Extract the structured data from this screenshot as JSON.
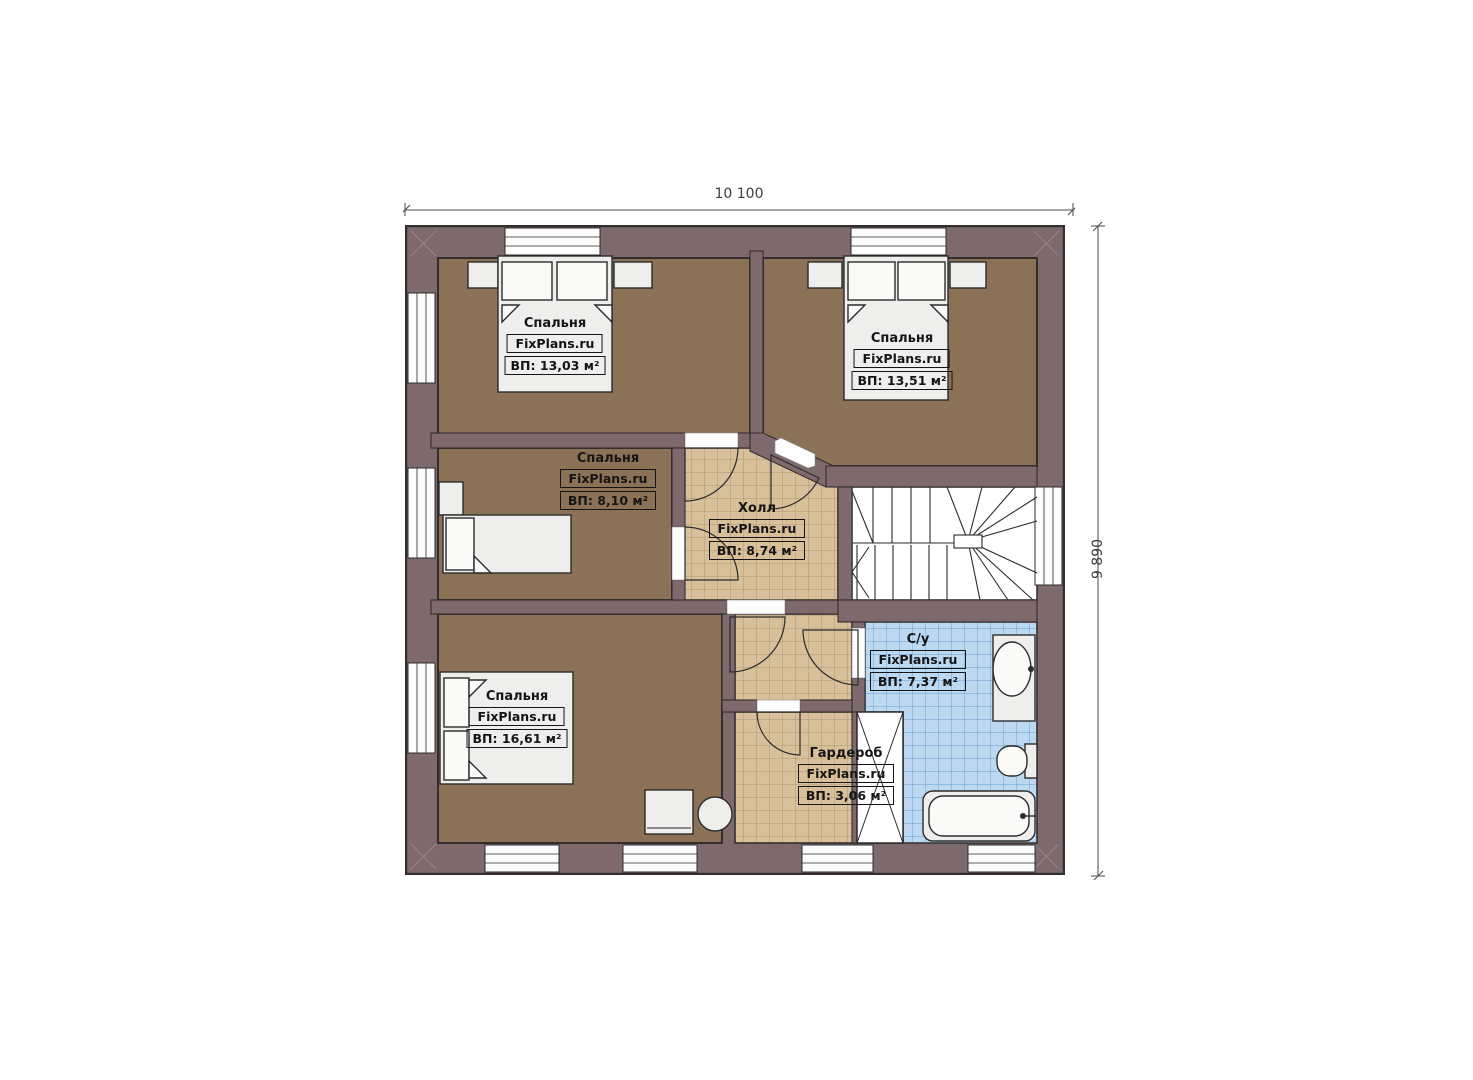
{
  "dimensions": {
    "width_label": "10 100",
    "height_label": "9 890"
  },
  "rooms": [
    {
      "id": "bedroom-top-left",
      "name": "Спальня",
      "watermark": "FixPlans.ru",
      "area": "ВП: 13,03 м²"
    },
    {
      "id": "bedroom-top-right",
      "name": "Спальня",
      "watermark": "FixPlans.ru",
      "area": "ВП: 13,51 м²"
    },
    {
      "id": "bedroom-middle-left",
      "name": "Спальня",
      "watermark": "FixPlans.ru",
      "area": "ВП: 8,10 м²"
    },
    {
      "id": "hall",
      "name": "Холл",
      "watermark": "FixPlans.ru",
      "area": "ВП: 8,74 м²"
    },
    {
      "id": "bedroom-bottom-left",
      "name": "Спальня",
      "watermark": "FixPlans.ru",
      "area": "ВП: 16,61 м²"
    },
    {
      "id": "bathroom",
      "name": "С/у",
      "watermark": "FixPlans.ru",
      "area": "ВП: 7,37 м²"
    },
    {
      "id": "wardrobe",
      "name": "Гардероб",
      "watermark": "FixPlans.ru",
      "area": "ВП: 3,06 м²"
    }
  ],
  "colors": {
    "wall": "#7e6a6c",
    "wall_line": "#332d2d",
    "floor": "#8b7257",
    "tan": "#d8c09a",
    "tan_line": "#ae9770",
    "blue": "#bdd9f2",
    "blue_line": "#6f9fd0",
    "furn": "#eeeeec",
    "ink": "#151515",
    "dim": "#3c3c3c"
  }
}
